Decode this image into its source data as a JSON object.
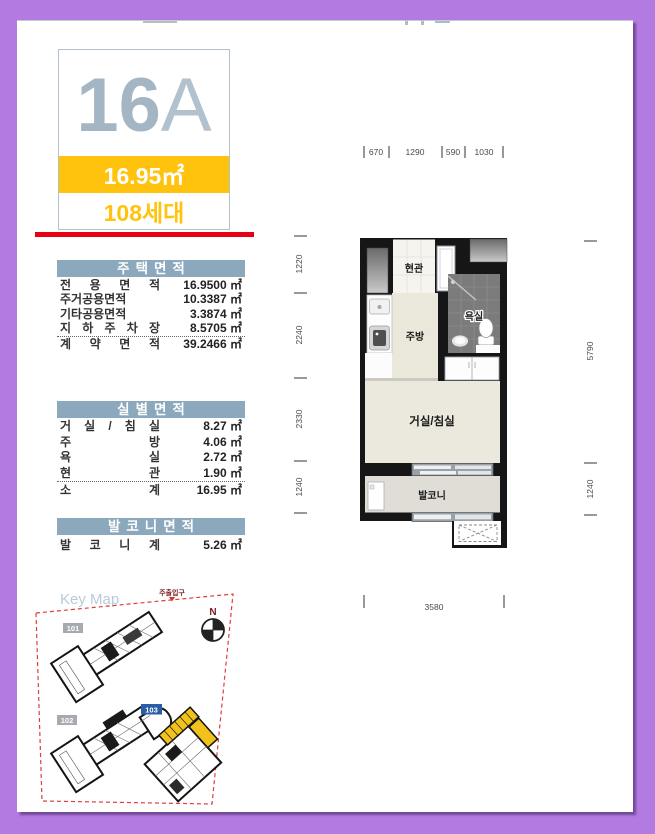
{
  "page": {
    "colors": {
      "frame_purple": "#b37ae2",
      "accent_yellow": "#ffc30e",
      "underline_red": "#e60012",
      "table_header_blue": "#8ba8bd",
      "keymap_building_blue": "#2a5da8"
    },
    "unit": {
      "type_number": "16",
      "type_letter": "A",
      "area_badge": "16.95㎡",
      "household_count": "108세대"
    },
    "tables": {
      "housing": {
        "title": "주택면적",
        "rows": [
          {
            "label": "전 용 면 적",
            "value": "16.9500 ㎡"
          },
          {
            "label": "주거공용면적",
            "value": "10.3387 ㎡"
          },
          {
            "label": "기타공용면적",
            "value": "3.3874 ㎡"
          },
          {
            "label": "지 하 주 차 장",
            "value": "8.5705 ㎡"
          },
          {
            "label": "계 약 면 적",
            "value": "39.2466 ㎡"
          }
        ]
      },
      "rooms": {
        "title": "실별면적",
        "rows": [
          {
            "label": "거 실 / 침 실",
            "value": "8.27 ㎡"
          },
          {
            "label": "주 방",
            "value": "4.06 ㎡"
          },
          {
            "label": "욕 실",
            "value": "2.72 ㎡"
          },
          {
            "label": "현 관",
            "value": "1.90 ㎡"
          },
          {
            "label": "소 계",
            "value": "16.95 ㎡"
          }
        ]
      },
      "balcony": {
        "title": "발코니면적",
        "rows": [
          {
            "label": "발 코 니 계",
            "value": "5.26 ㎡"
          }
        ]
      }
    },
    "keymap": {
      "title": "Key Map",
      "entrance_label": "주출입구",
      "compass_label": "N",
      "buildings": [
        {
          "id": "101"
        },
        {
          "id": "102"
        },
        {
          "id": "103"
        }
      ]
    },
    "plan": {
      "rooms": {
        "entrance": "현관",
        "kitchen": "주방",
        "bath": "욕실",
        "living": "거실/침실",
        "balcony": "발코니"
      },
      "dims": {
        "top": [
          "670",
          "1290",
          "590",
          "1030"
        ],
        "left": [
          "1220",
          "2240",
          "2330",
          "1240"
        ],
        "right": [
          "5790",
          "1240"
        ],
        "bottom": [
          "3580"
        ]
      }
    }
  }
}
